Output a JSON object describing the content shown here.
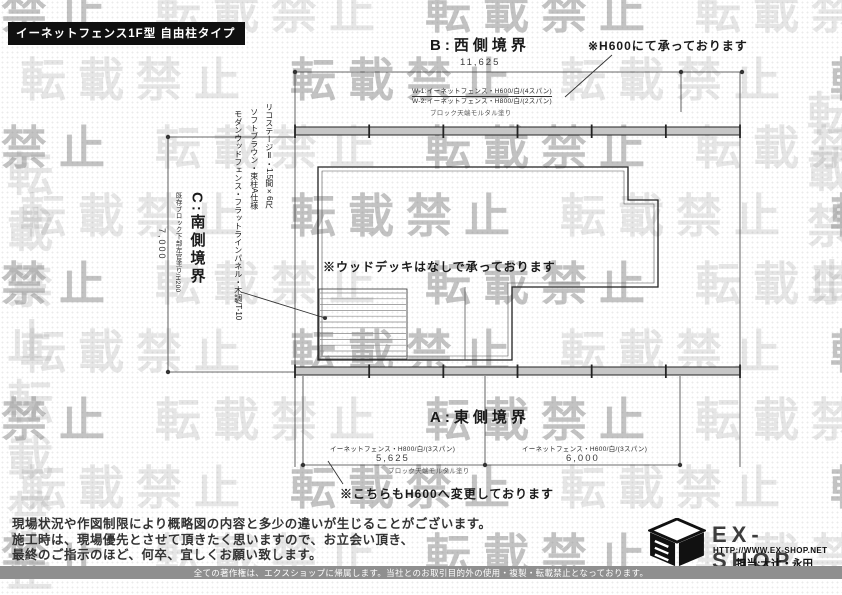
{
  "colors": {
    "watermark_gray": "#9a9a9a",
    "fence_gray": "#c6c6c6",
    "footer_bar_gray": "#8f8f8f",
    "title_bg": "#101010"
  },
  "watermark": {
    "text": "転載禁止"
  },
  "title_box": {
    "label": "イーネットフェンス1F型 自由柱タイプ"
  },
  "plan": {
    "west": {
      "label": "B:西側境界",
      "dimension": "11,625",
      "spec1": "W-1:イーネットフェンス・H600/白/(4スパン)",
      "spec2": "W-2:イーネットフェンス・H800/白/(2スパン)",
      "block_note": "ブロック天端モルタル塗り",
      "note": "※H600にて承っております"
    },
    "east": {
      "label": "A:東側境界",
      "seg1_spec": "イーネットフェンス・H800/白/(3スパン)",
      "seg1_dim": "5,625",
      "seg2_spec": "イーネットフェンス・H600/白/(3スパン)",
      "seg2_dim": "6,000",
      "block_note": "ブロック天端モルタル塗り",
      "note": "※こちらもH600へ変更しております"
    },
    "south": {
      "label": "C:南側境界",
      "existing_note": "既存ブロック下部左官塗り/H200",
      "dimension": "7,000"
    },
    "deck": {
      "line1": "リコステージⅡ・1.5間×6尺",
      "line2": "ソフトブラウン・束柱A仕様",
      "line3": "モダンウッドフェンス・フラットラインパネル・木調/T-10",
      "note": "※ウッドデッキはなしで承っております"
    }
  },
  "footer": {
    "disclaimer1": "現場状況や作図制限により概略図の内容と多少の違いが生じることがございます。",
    "disclaimer2": "施工時は、現場優先とさせて頂きたく思いますので、お立会い頂き、",
    "disclaimer3": "最終のご指示のほど、何卒、宜しくお願い致します。",
    "logo": {
      "name": "EX-SHOP",
      "url": "HTTP://WWW.EX-SHOP.NET",
      "staff": "担当:大辻・永田"
    },
    "copyright": "全ての著作権は、エクスショップに帰属します。当社とのお取引目的外の使用・複製・転載禁止となっております。"
  }
}
